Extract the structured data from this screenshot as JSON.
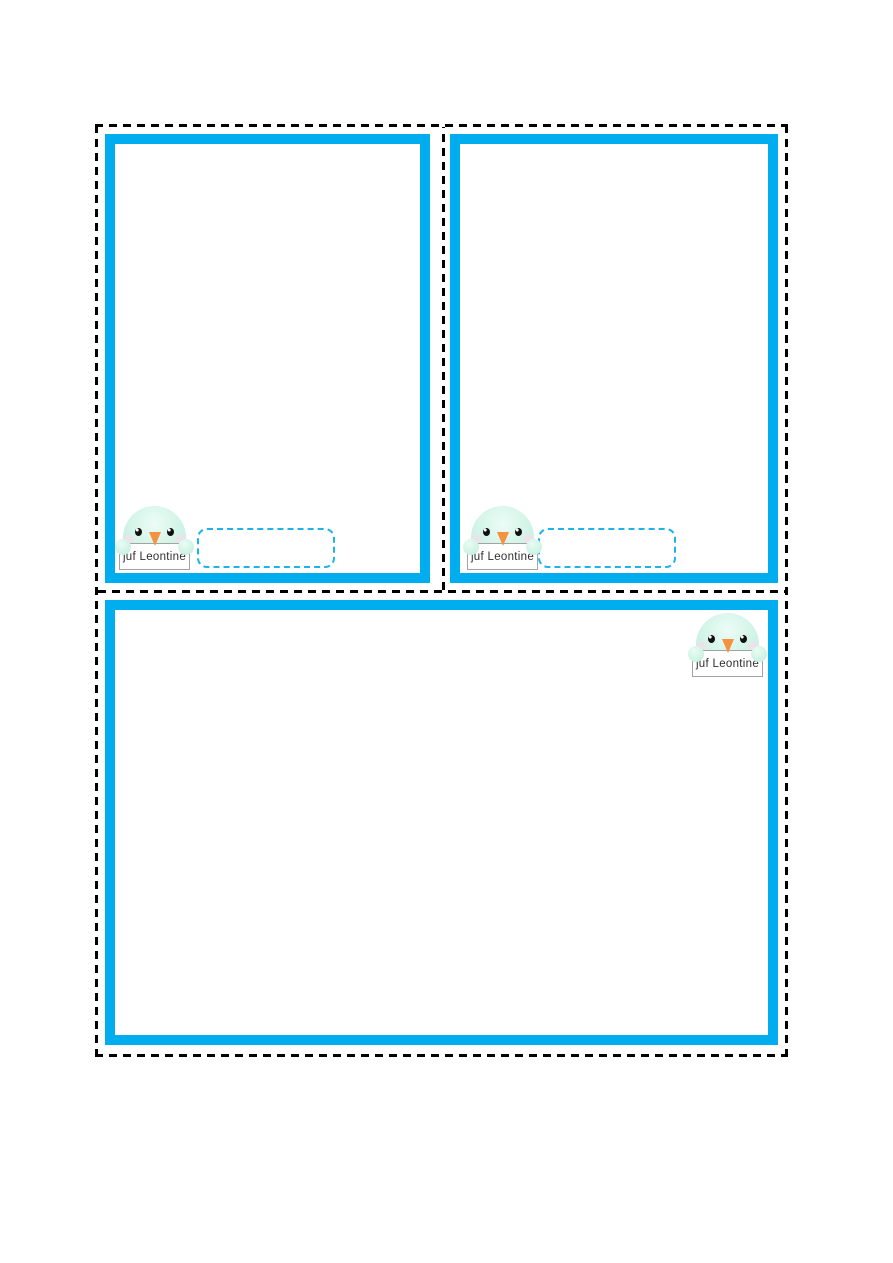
{
  "colors": {
    "card_frame": "#00aeef",
    "cut_line": "#000000",
    "name_box_border": "#1fb3ec",
    "bird_body": "#c9f2e4",
    "bird_beak": "#f5913f",
    "sign_border": "#a3a3a3",
    "sign_text": "#2f2f2f"
  },
  "cards": [
    {
      "id": "top-left-card",
      "mascot": {
        "icon": "bird-mascot-icon",
        "label": "juf Leontine"
      },
      "name_box": {
        "value": ""
      }
    },
    {
      "id": "top-right-card",
      "mascot": {
        "icon": "bird-mascot-icon",
        "label": "juf Leontine"
      },
      "name_box": {
        "value": ""
      }
    },
    {
      "id": "bottom-card",
      "mascot": {
        "icon": "bird-mascot-icon",
        "label": "juf Leontine"
      }
    }
  ]
}
